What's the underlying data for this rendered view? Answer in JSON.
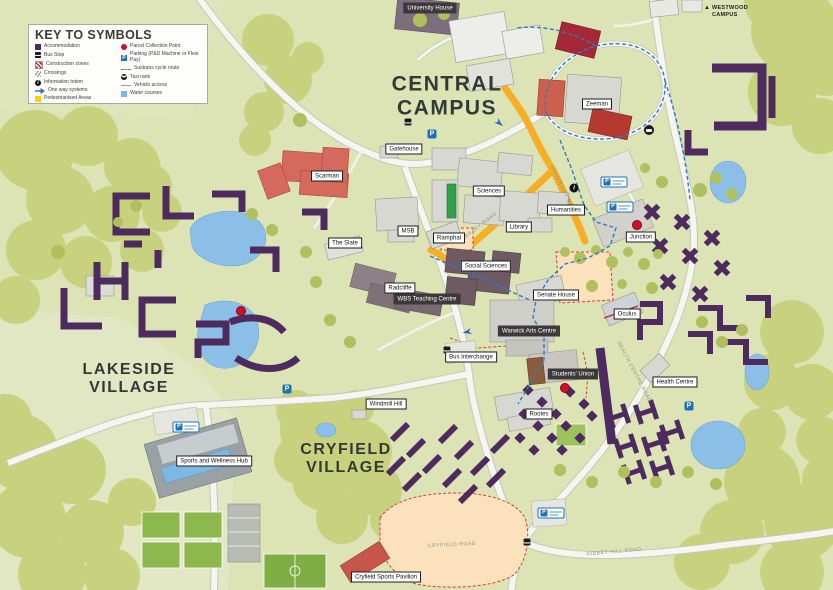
{
  "legend": {
    "title": "KEY TO SYMBOLS",
    "columns": [
      {
        "items": [
          {
            "icon": "accommodation-icon",
            "label": "Accommodation"
          },
          {
            "icon": "bus-stop-icon",
            "label": "Bus Stop"
          },
          {
            "icon": "construction-icon",
            "label": "Construction zones"
          },
          {
            "icon": "crossings-icon",
            "label": "Crossings"
          },
          {
            "icon": "information-totem-icon",
            "label": "Information totem"
          },
          {
            "icon": "one-way-icon",
            "label": "One way systems"
          },
          {
            "icon": "pedestrianised-icon",
            "label": "Pedestrianised Areas"
          }
        ]
      },
      {
        "items": [
          {
            "icon": "parcel-collection-icon",
            "label": "Parcel Collection Point"
          },
          {
            "icon": "parking-icon",
            "label": "Parking (P&D Machine or Flexi Pay)"
          },
          {
            "icon": "cycle-route-icon",
            "label": "Sustrans cycle route"
          },
          {
            "icon": "taxi-rank-icon",
            "label": "Taxi rank"
          },
          {
            "icon": "vehicle-access-icon",
            "label": "Vehicle access"
          },
          {
            "icon": "water-courses-icon",
            "label": "Water courses"
          }
        ]
      }
    ]
  },
  "districts": {
    "central": "CENTRAL\nCAMPUS",
    "lakeside": "LAKESIDE\nVILLAGE",
    "cryfield": "CRYFIELD\nVILLAGE",
    "westwood": "WESTWOOD\nCAMPUS",
    "westwood_arrow": "▲"
  },
  "labels": [
    {
      "text": "University House"
    },
    {
      "text": "Zeeman"
    },
    {
      "text": "Gatehouse"
    },
    {
      "text": "Scarman"
    },
    {
      "text": "Sciences"
    },
    {
      "text": "Humanities"
    },
    {
      "text": "Library"
    },
    {
      "text": "MSB"
    },
    {
      "text": "Ramphal"
    },
    {
      "text": "The Slate"
    },
    {
      "text": "Social Sciences"
    },
    {
      "text": "Radcliffe"
    },
    {
      "text": "WBS Teaching Centre"
    },
    {
      "text": "Senate House"
    },
    {
      "text": "Warwick Arts Centre"
    },
    {
      "text": "Junction"
    },
    {
      "text": "Oculus"
    },
    {
      "text": "Health Centre"
    },
    {
      "text": "Bus Interchange"
    },
    {
      "text": "Students' Union"
    },
    {
      "text": "Rootes"
    },
    {
      "text": "Windmill Hill"
    },
    {
      "text": "Sports and Wellness Hub"
    },
    {
      "text": "Cryfield Sports Pavilion"
    }
  ],
  "roads": [
    {
      "text": "UNIVERSITY ROAD"
    },
    {
      "text": "LIBRARY ROAD"
    },
    {
      "text": "GIBBET HILL ROAD"
    },
    {
      "text": "CRYFIELD ROAD"
    },
    {
      "text": "HEALTH CENTRE ROAD"
    }
  ],
  "symbols": {
    "parking": "P",
    "info": "i"
  },
  "colors": {
    "accommodation": "#4d2b5e",
    "pedestrianised": "#ffd10a",
    "parking_blue": "#1d71b8",
    "parcel_red": "#ce0e2d",
    "water_blue": "#7fb2e5",
    "cycle_route": "#2f7bbf",
    "construction_red": "#e23a2e"
  }
}
